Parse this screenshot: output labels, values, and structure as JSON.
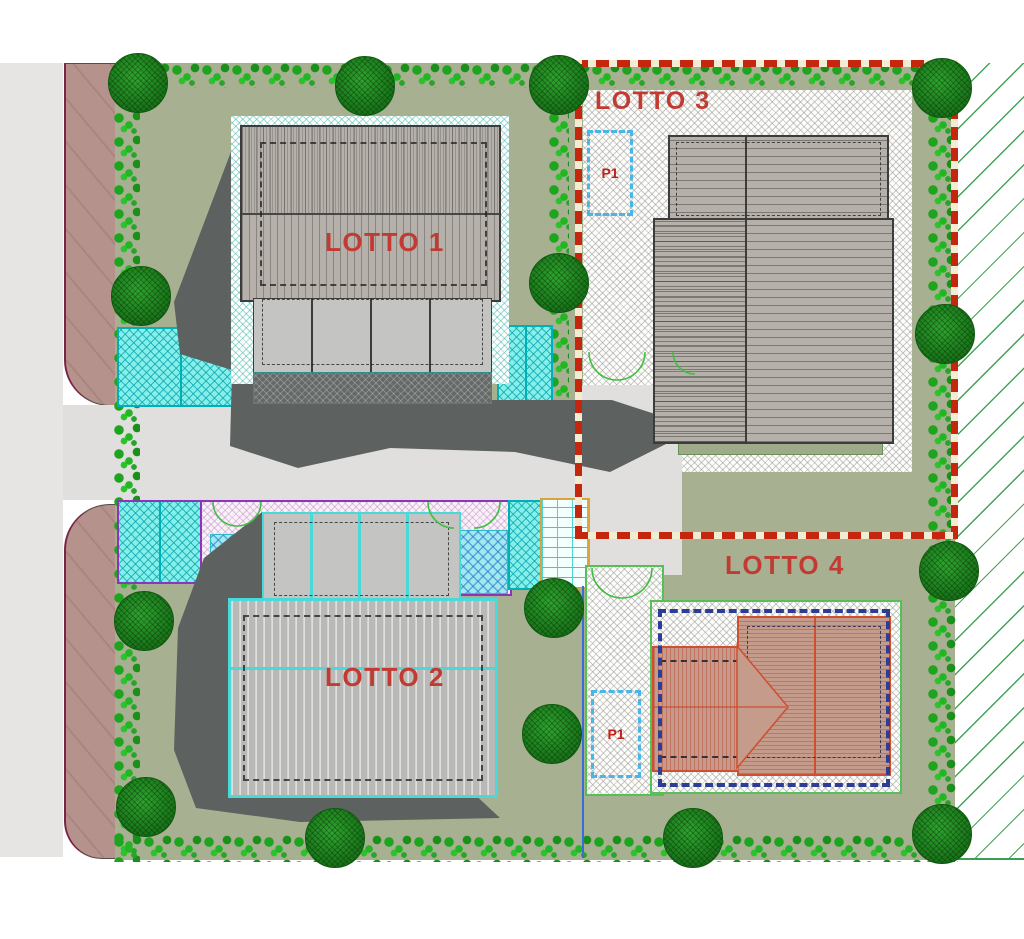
{
  "site_plan": {
    "lots": [
      {
        "id": "lotto-1",
        "label": "LOTTO 1"
      },
      {
        "id": "lotto-2",
        "label": "LOTTO 2"
      },
      {
        "id": "lotto-3",
        "label": "LOTTO 3"
      },
      {
        "id": "lotto-4",
        "label": "LOTTO 4"
      }
    ],
    "parking_spaces": [
      {
        "id": "p1-lotto-3",
        "label": "P1"
      },
      {
        "id": "p1-lotto-4",
        "label": "P1"
      }
    ],
    "colors": {
      "lot_label_red": "#c23b33",
      "boundary_dashed_red": "#c5270e",
      "building_boundary_dashed_blue": "#2c3e94",
      "parking_dashed_cyan": "#49b6e8",
      "lawn_green": "#a8b092",
      "hedge_green": "#23b523",
      "tree_green": "#1b7a1b",
      "road_gray": "#e0dfdd",
      "sidewalk_brown": "#b5928b",
      "roof_gray": "#b6b0aa",
      "roof_terracotta": "#c59c8c",
      "driveway_aqua": "#86efe9",
      "canopy_outline_cyan": "#4ad9d9",
      "field_hatch_green": "#3aa050"
    }
  }
}
